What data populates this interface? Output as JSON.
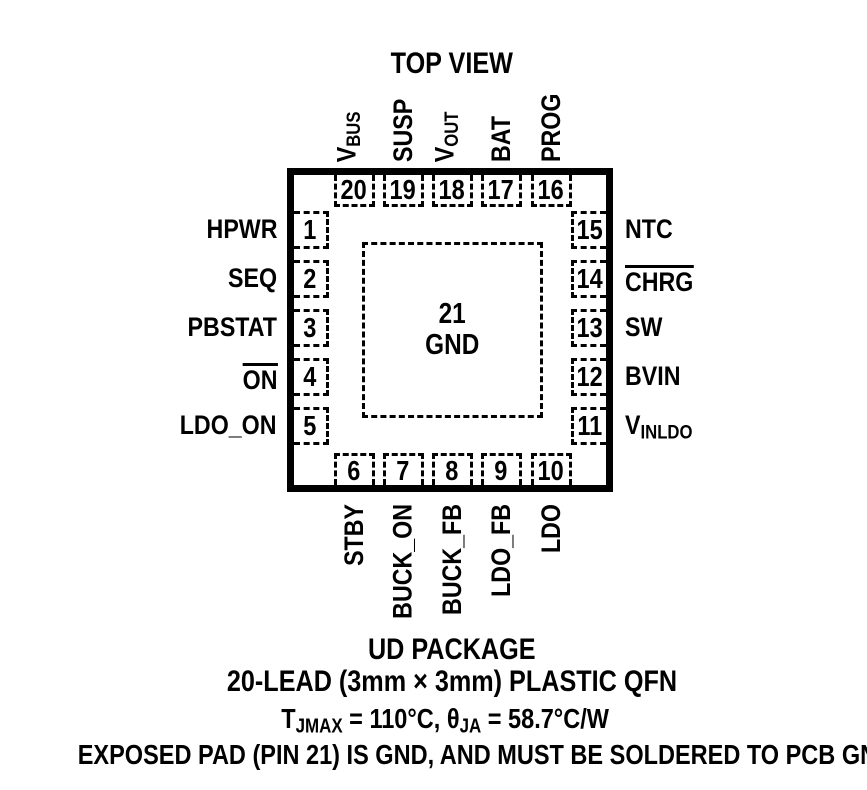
{
  "title": "TOP VIEW",
  "ink_color": "#000000",
  "background_color": "#ffffff",
  "package": {
    "center_pad": {
      "number": "21",
      "name": "GND"
    },
    "pins": {
      "top": [
        {
          "number": "20",
          "name": "vbus",
          "parts": [
            {
              "text": "V"
            },
            {
              "text": "BUS",
              "sub": true
            }
          ]
        },
        {
          "number": "19",
          "name": "susp",
          "parts": [
            {
              "text": "SUSP"
            }
          ]
        },
        {
          "number": "18",
          "name": "vout",
          "parts": [
            {
              "text": "V"
            },
            {
              "text": "OUT",
              "sub": true
            }
          ]
        },
        {
          "number": "17",
          "name": "bat",
          "parts": [
            {
              "text": "BAT"
            }
          ]
        },
        {
          "number": "16",
          "name": "prog",
          "parts": [
            {
              "text": "PROG"
            }
          ]
        }
      ],
      "left": [
        {
          "number": "1",
          "name": "hpwr",
          "parts": [
            {
              "text": "HPWR"
            }
          ]
        },
        {
          "number": "2",
          "name": "seq",
          "parts": [
            {
              "text": "SEQ"
            }
          ]
        },
        {
          "number": "3",
          "name": "pbstat",
          "parts": [
            {
              "text": "PBSTAT"
            }
          ]
        },
        {
          "number": "4",
          "name": "on",
          "overline": true,
          "parts": [
            {
              "text": "ON"
            }
          ]
        },
        {
          "number": "5",
          "name": "ldo-on",
          "parts": [
            {
              "text": "LDO_ON"
            }
          ]
        }
      ],
      "right": [
        {
          "number": "15",
          "name": "ntc",
          "parts": [
            {
              "text": "NTC"
            }
          ]
        },
        {
          "number": "14",
          "name": "chrg",
          "overline": true,
          "parts": [
            {
              "text": "CHRG"
            }
          ]
        },
        {
          "number": "13",
          "name": "sw",
          "parts": [
            {
              "text": "SW"
            }
          ]
        },
        {
          "number": "12",
          "name": "bvin",
          "parts": [
            {
              "text": "BVIN"
            }
          ]
        },
        {
          "number": "11",
          "name": "vinldo",
          "parts": [
            {
              "text": "V"
            },
            {
              "text": "INLDO",
              "sub": true
            }
          ]
        }
      ],
      "bottom": [
        {
          "number": "6",
          "name": "stby",
          "parts": [
            {
              "text": "STBY"
            }
          ]
        },
        {
          "number": "7",
          "name": "buck-on",
          "parts": [
            {
              "text": "BUCK_ON"
            }
          ]
        },
        {
          "number": "8",
          "name": "buck-fb",
          "parts": [
            {
              "text": "BUCK_FB"
            }
          ]
        },
        {
          "number": "9",
          "name": "ldo-fb",
          "parts": [
            {
              "text": "LDO_FB"
            }
          ]
        },
        {
          "number": "10",
          "name": "ldo",
          "parts": [
            {
              "text": "LDO"
            }
          ]
        }
      ]
    }
  },
  "footer": {
    "package_name": "UD PACKAGE",
    "lead_description": "20-LEAD (3mm × 3mm) PLASTIC QFN",
    "thermal": {
      "t": "T",
      "t_sub": "JMAX",
      "mid": " = 110°C, ",
      "theta": "θ",
      "theta_sub": "JA",
      "tail": " = 58.7°C/W"
    },
    "exposed_pad_note": "EXPOSED PAD (PIN 21) IS GND, AND MUST BE SOLDERED TO PCB GND"
  }
}
